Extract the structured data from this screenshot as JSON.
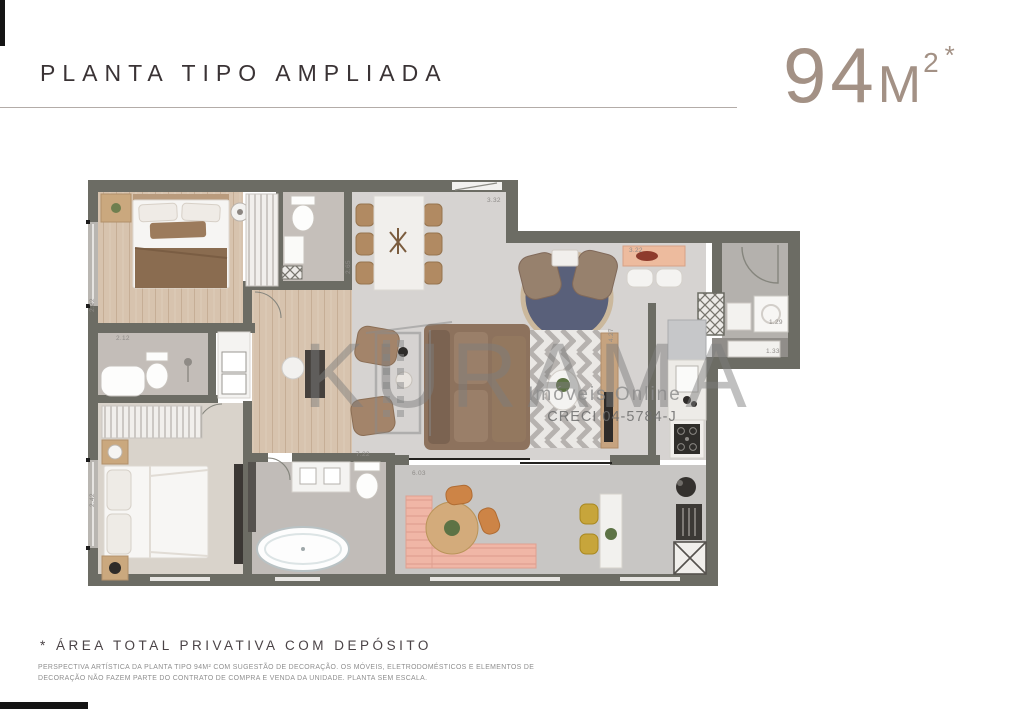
{
  "header": {
    "title": "PLANTA TIPO AMPLIADA",
    "area": {
      "number": "94",
      "unit": "M",
      "superscript": "2",
      "asterisk": "*"
    }
  },
  "watermark": {
    "brand": "KURAMA",
    "tagline": "Imóveis Online",
    "license": "CRECI 04-5784-J"
  },
  "plan": {
    "measurements": [
      {
        "text": "3.32",
        "x": 487,
        "y": 202,
        "rot": 0
      },
      {
        "text": "2.65",
        "x": 350,
        "y": 274,
        "rot": -90
      },
      {
        "text": "3.22",
        "x": 629,
        "y": 252,
        "rot": 0
      },
      {
        "text": "1.29",
        "x": 769,
        "y": 324,
        "rot": 0
      },
      {
        "text": "1.33",
        "x": 766,
        "y": 353,
        "rot": 0
      },
      {
        "text": "4.27",
        "x": 613,
        "y": 342,
        "rot": -90
      },
      {
        "text": "7.22",
        "x": 356,
        "y": 456,
        "rot": 0
      },
      {
        "text": "6.03",
        "x": 412,
        "y": 475,
        "rot": 0
      },
      {
        "text": "2.82",
        "x": 94,
        "y": 312,
        "rot": -90
      },
      {
        "text": "2.12",
        "x": 116,
        "y": 340,
        "rot": 0
      },
      {
        "text": "2.42",
        "x": 94,
        "y": 507,
        "rot": -90
      }
    ]
  },
  "footer": {
    "note": "* ÁREA TOTAL PRIVATIVA COM DEPÓSITO",
    "disclaimer": [
      "PERSPECTIVA ARTÍSTICA DA PLANTA TIPO 94M² COM SUGESTÃO DE DECORAÇÃO. OS MÓVEIS, ELETRODOMÉSTICOS E ELEMENTOS DE",
      "DECORAÇÃO NÃO FAZEM PARTE DO CONTRATO DE COMPRA E VENDA DA UNIDADE. PLANTA SEM ESCALA."
    ]
  },
  "colors": {
    "accent_black": "#141414",
    "area_text": "#a39185",
    "wall": "#6c6c64",
    "wood_floor": "#d7c3ae",
    "living_floor": "#d6d3d1",
    "balcony_floor": "#c8c6c4",
    "rug_navy": "#59607a",
    "bench_pink": "#f0b6a6",
    "stool_yellow": "#c7a53b",
    "sofa_brown": "#8d725d"
  }
}
